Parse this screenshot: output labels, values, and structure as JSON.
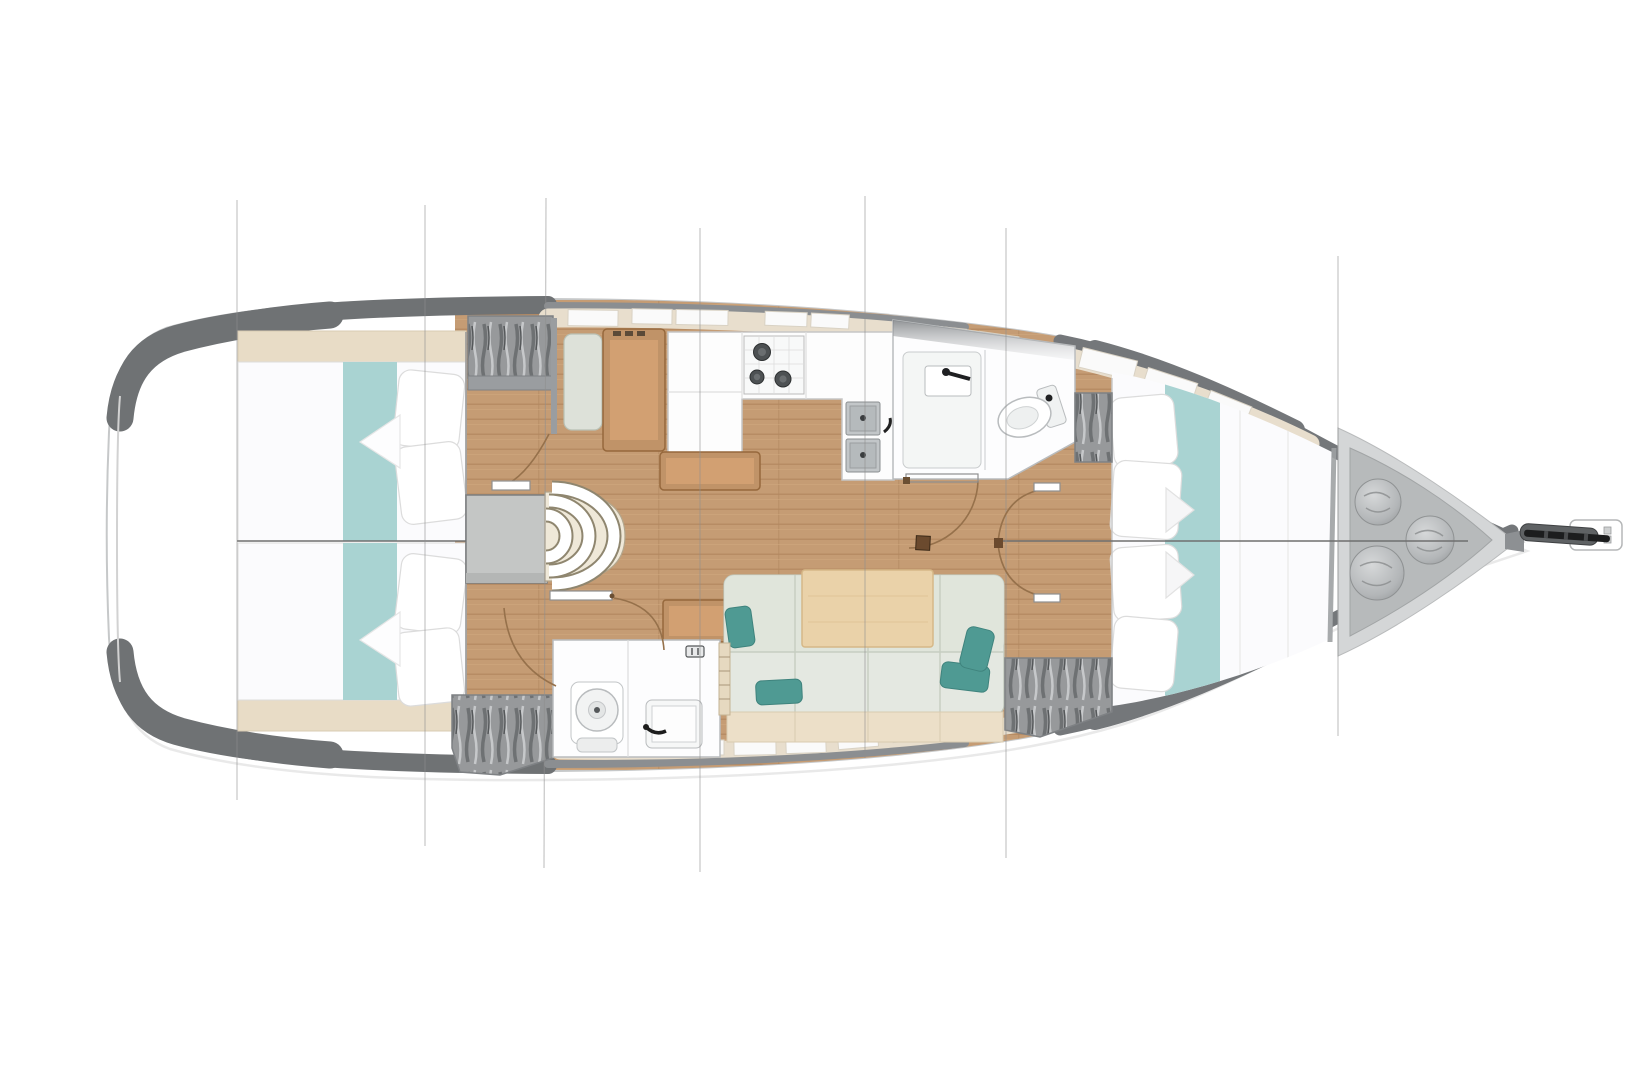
{
  "diagram": {
    "type": "yacht-interior-floor-plan",
    "view": "overhead deck plan, no text labels visible",
    "orientation": {
      "bow": "right",
      "stern": "left"
    },
    "rooms": [
      {
        "id": "aft-cabin-port",
        "position": "stern upper half",
        "furniture": [
          "double berth with white duvet",
          "teal bed runner",
          "two pillows",
          "shelf trim"
        ]
      },
      {
        "id": "aft-cabin-starboard",
        "position": "stern lower half",
        "furniture": [
          "double berth with white duvet",
          "teal bed runner",
          "two pillows",
          "shelf trim"
        ]
      },
      {
        "id": "companionway",
        "position": "amidships aft",
        "furniture": [
          "three curved steps",
          "engine compartment box"
        ]
      },
      {
        "id": "nav-station",
        "position": "port amidships",
        "furniture": [
          "seat cushion",
          "wood chart table"
        ]
      },
      {
        "id": "galley",
        "position": "port side",
        "furniture": [
          "refrigerator and counter block",
          "three-burner stove",
          "counter",
          "double sink with tap",
          "island counter"
        ]
      },
      {
        "id": "head-with-shower",
        "position": "port forward of galley",
        "furniture": [
          "shower pan",
          "wall recess",
          "black mixer tap",
          "toilet"
        ]
      },
      {
        "id": "day-head",
        "position": "starboard amidships",
        "furniture": [
          "toilet",
          "washbasin",
          "black tap",
          "vent glyph"
        ]
      },
      {
        "id": "salon",
        "position": "starboard",
        "furniture": [
          "single tan seat",
          "long settee",
          "four teal accent pillows",
          "wood dining table",
          "mast step block"
        ]
      },
      {
        "id": "forward-cabin",
        "position": "bow side",
        "furniture": [
          "island berth with white duvet",
          "teal bed runner",
          "four pillows",
          "two hanging lockers"
        ]
      },
      {
        "id": "anchor-locker",
        "position": "bow tip",
        "furniture": [
          "three mooring rope coils",
          "anchor roller with chain",
          "white bow plate"
        ]
      }
    ],
    "wardrobes_count": 4,
    "door_swing_arcs_count": 6,
    "deck_hatches_top_count": 10,
    "deck_hatches_bottom_count": 6,
    "station_lines_x": [
      237,
      425,
      545,
      700,
      865,
      1006,
      1338
    ],
    "centerline_y": 541
  },
  "colors": {
    "bedding_runner_teal": "#a9d3d2",
    "accent_pillow_teal": "#4f9a93",
    "wood_floor": "#c59c74",
    "furniture_wood": "#c09368",
    "furniture_wood_inner": "#d2a072",
    "deck_trim_beige": "#e8decd",
    "hull_band_gray": "#6f7274",
    "wardrobe_gray": "#97999b",
    "locker_gray": "#b7babb",
    "duvet_white": "#fbfbfd"
  }
}
